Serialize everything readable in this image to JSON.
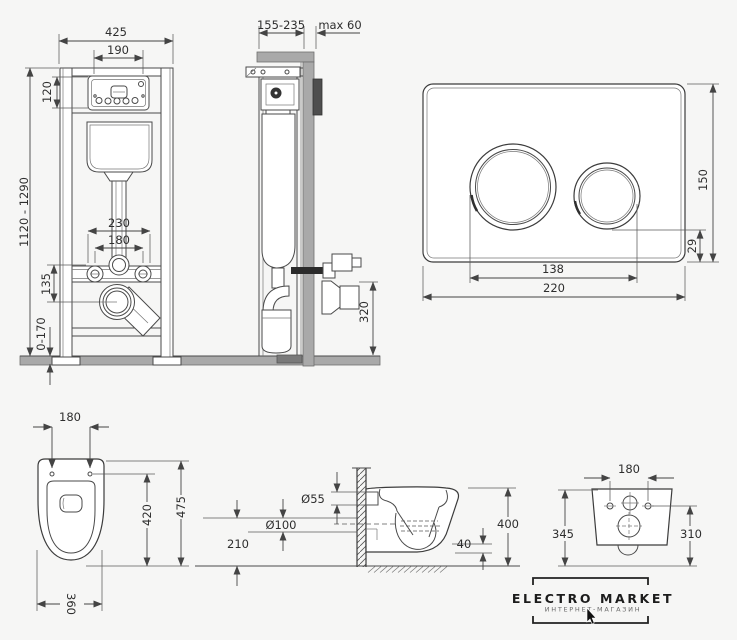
{
  "views": {
    "frame_front": {
      "name": "installation frame front view",
      "dims": {
        "width_total": "425",
        "width_inner": "190",
        "panel_height": "120",
        "height_range": "1120 - 1290",
        "bolt_spacing_wide": "230",
        "bolt_spacing_narrow": "180",
        "drain_offset": "135",
        "foot_range": "0-170"
      }
    },
    "frame_side": {
      "name": "installation frame side view",
      "dims": {
        "depth_range": "155-235",
        "wall_max": "max 60",
        "outlet_height": "320"
      }
    },
    "flush_plate": {
      "name": "flush plate",
      "dims": {
        "height": "150",
        "button_offset": "29",
        "button_span": "138",
        "width": "220"
      }
    },
    "bowl_top": {
      "name": "bowl top view",
      "dims": {
        "hole_spacing": "180",
        "length_total": "475",
        "length_inner": "420",
        "width": "360"
      }
    },
    "bowl_side": {
      "name": "bowl side view",
      "dims": {
        "inlet": "Ø55",
        "outlet": "Ø100",
        "outlet_height": "210",
        "height_total": "400",
        "lip": "40"
      }
    },
    "bowl_back": {
      "name": "bowl back view",
      "dims": {
        "hole_spacing": "180",
        "height_left": "345",
        "height_right": "310"
      }
    }
  },
  "logo": {
    "title": "ELECTRO MARKET",
    "subtitle": "ИНТЕРНЕТ-МАГАЗИН"
  },
  "colors": {
    "background": "#f6f6f5",
    "structure_line": "#4a4a4a",
    "dimension_line": "#444444",
    "wall_gray": "#a9a9a9",
    "plate_dark": "#4e4e4e",
    "logo_text": "#1c1c1c"
  }
}
